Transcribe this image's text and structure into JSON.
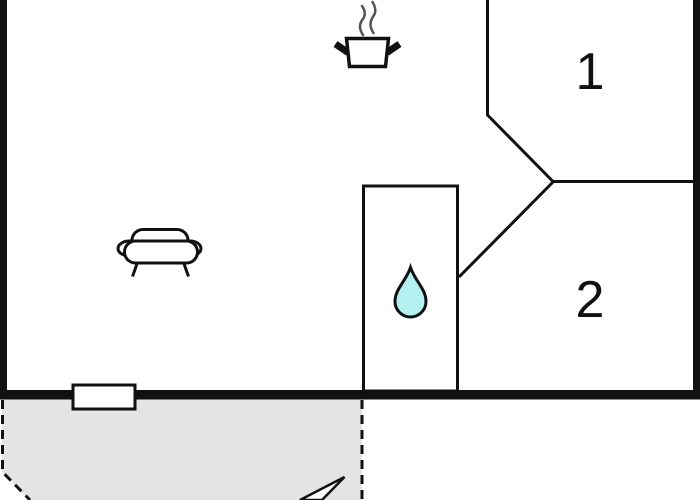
{
  "page": {
    "type": "floor-plan"
  },
  "floor_plan": {
    "rooms": [
      {
        "name": "room-1",
        "label": "1"
      },
      {
        "name": "room-2",
        "label": "2"
      }
    ],
    "icons": [
      {
        "name": "cooking-pot-icon",
        "shape": "pot with two handles and two steam waves"
      },
      {
        "name": "sofa-icon",
        "shape": "sofa front view with two armrests and two legs"
      },
      {
        "name": "water-drop-icon",
        "shape": "teardrop"
      },
      {
        "name": "window-icon",
        "shape": "white rectangle on bottom wall"
      },
      {
        "name": "terrace-arrow-icon",
        "shape": "arrow tip pointing up-right, clipped by bottom edge"
      }
    ],
    "areas": [
      {
        "name": "terrace",
        "outline": "dashed"
      },
      {
        "name": "bathroom",
        "outline": "solid rectangle"
      }
    ]
  },
  "colors": {
    "wall": "#111111",
    "steam": "#555555",
    "drop_fill": "#b2f1ef",
    "terrace_fill": "#e4e4e4",
    "background": "#ffffff"
  }
}
